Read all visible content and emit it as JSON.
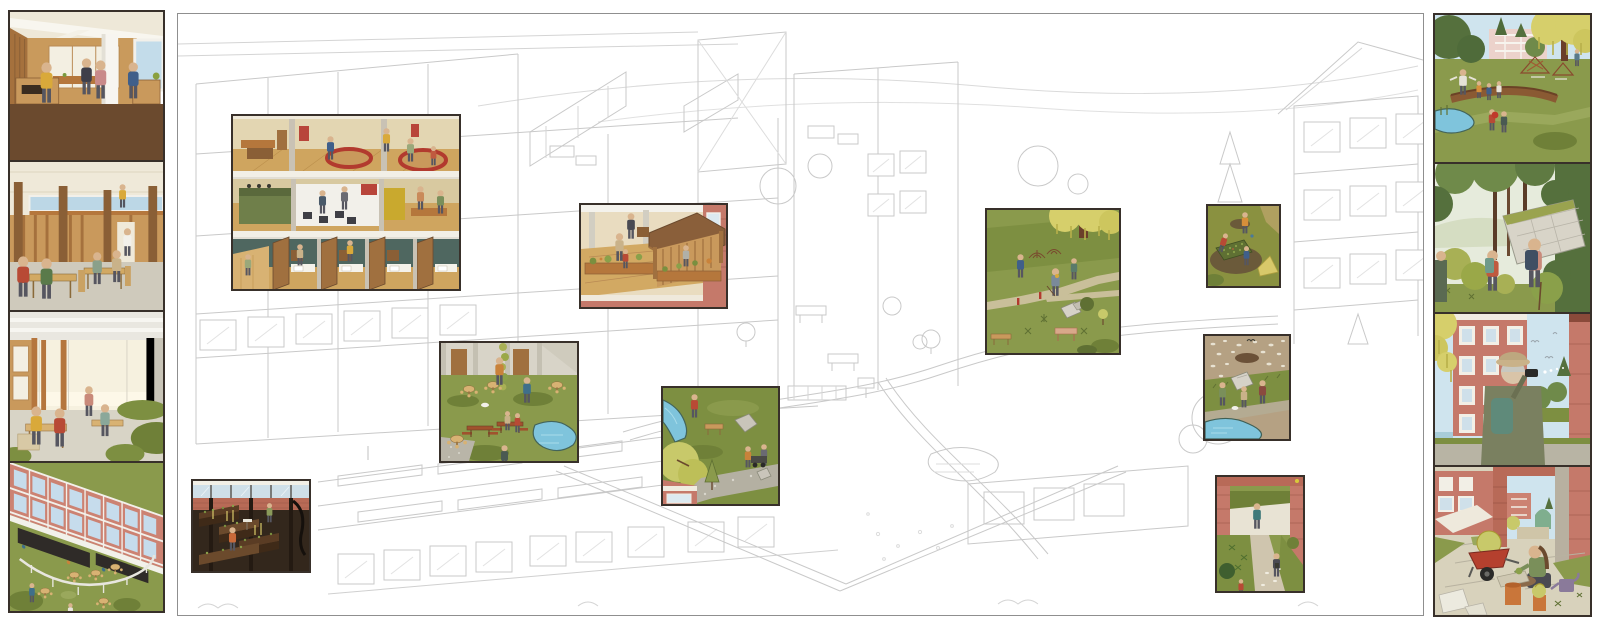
{
  "artwork": {
    "kind": "architectural illustration board",
    "description": "Axonometric line drawing of a housing block and park with colored highlight scenes",
    "text_visible": false
  },
  "palette": {
    "paper": "#ffffff",
    "lineart": "#c9c9c9",
    "frame_dark": "#38302a",
    "brick": "#c5796a",
    "brick_light": "#cc8272",
    "glass_blue": "#c3dcea",
    "sky": "#cfe4ee",
    "grass": "#8a9a4c",
    "grass_dark": "#6f8038",
    "olive_dark": "#5f7033",
    "willow_yellow": "#d6cf6b",
    "yellow_green": "#c8c96a",
    "water": "#7fc4dc",
    "wood_light": "#d2a963",
    "wood_mid": "#b5773c",
    "wood_dark": "#8a5f36",
    "floor_brown": "#6b4a2e",
    "cream": "#efe9d9",
    "concrete": "#d6d2c8",
    "soil_dark": "#5a3c24",
    "accent_red": "#b23a2e",
    "accent_orange": "#c9823a",
    "canopy_dark": "#2f2b28"
  },
  "left_column": {
    "panels": [
      {
        "name": "kitchen-counter-interior",
        "label": "Interior: people at a serving counter under white beams"
      },
      {
        "name": "dining-hall",
        "label": "Interior: dining hall with wooden tables and clerestory glazing"
      },
      {
        "name": "study-commons",
        "label": "Interior: work commons with timber posts and indoor planting"
      },
      {
        "name": "courtyard-aerial",
        "label": "Aerial: brick facade, canopy tables and round-table lawn"
      }
    ]
  },
  "center_board": {
    "name": "axonometric-site-drawing",
    "label": "Line drawing of building complex and park with nine colored scene insets",
    "insets": [
      {
        "name": "building-section-interiors",
        "label": "Cutaway: three stacked common floors with sunken lounges, gallery and study booths"
      },
      {
        "name": "terrace-gazebo",
        "label": "Roof terrace with timber gazebo and planter rail"
      },
      {
        "name": "courtyard-pond-picnic",
        "label": "Courtyard lawn with picnic tables and pond"
      },
      {
        "name": "meadow-stream-path",
        "label": "Meadow with stream, willow shrub and gravel path"
      },
      {
        "name": "park-willow-paths",
        "label": "Park lawn under willow with winding paths"
      },
      {
        "name": "planting-beds",
        "label": "Gardeners at planting beds in the field"
      },
      {
        "name": "pebble-shore-pond",
        "label": "Pebble shore and pond with visitors"
      },
      {
        "name": "brick-gateway-path",
        "label": "Path through a brick gateway"
      },
      {
        "name": "basement-growing-terraces",
        "label": "Underground growing terraces behind glazing"
      }
    ]
  },
  "right_column": {
    "panels": [
      {
        "name": "park-play",
        "label": "Park: den-building and curved log bench under willow"
      },
      {
        "name": "forest-ruin-walk",
        "label": "Hikers beside an overgrown tilted concrete slab"
      },
      {
        "name": "birdwatching-terrace",
        "label": "Birdwatcher with binoculars by the brick block"
      },
      {
        "name": "planting-courtyard",
        "label": "Gardener with red wheelbarrow between brick piers"
      }
    ]
  }
}
